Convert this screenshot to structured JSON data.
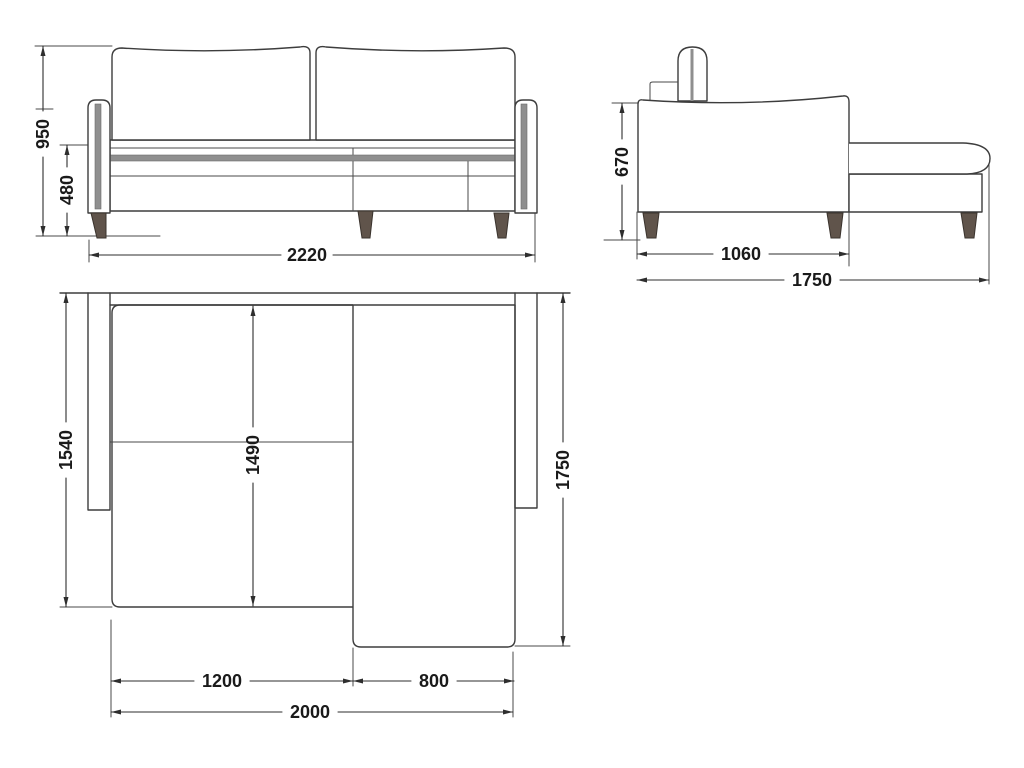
{
  "drawing": {
    "front_view": {
      "overall_height": "950",
      "seat_height": "480",
      "overall_width": "2220"
    },
    "side_view": {
      "back_height": "670",
      "body_depth": "1060",
      "total_depth": "1750"
    },
    "top_view": {
      "left_depth": "1540",
      "inner_length": "1490",
      "right_depth": "1750",
      "section_width": "1200",
      "chaise_width": "800",
      "total_length": "2000"
    }
  },
  "colors": {
    "outline": "#3d3d3d",
    "dimension": "#2e2e2e",
    "accent_band": "#8f8f8f",
    "leg": "#60544b",
    "background": "#ffffff",
    "label_text": "#1a1a1a"
  }
}
